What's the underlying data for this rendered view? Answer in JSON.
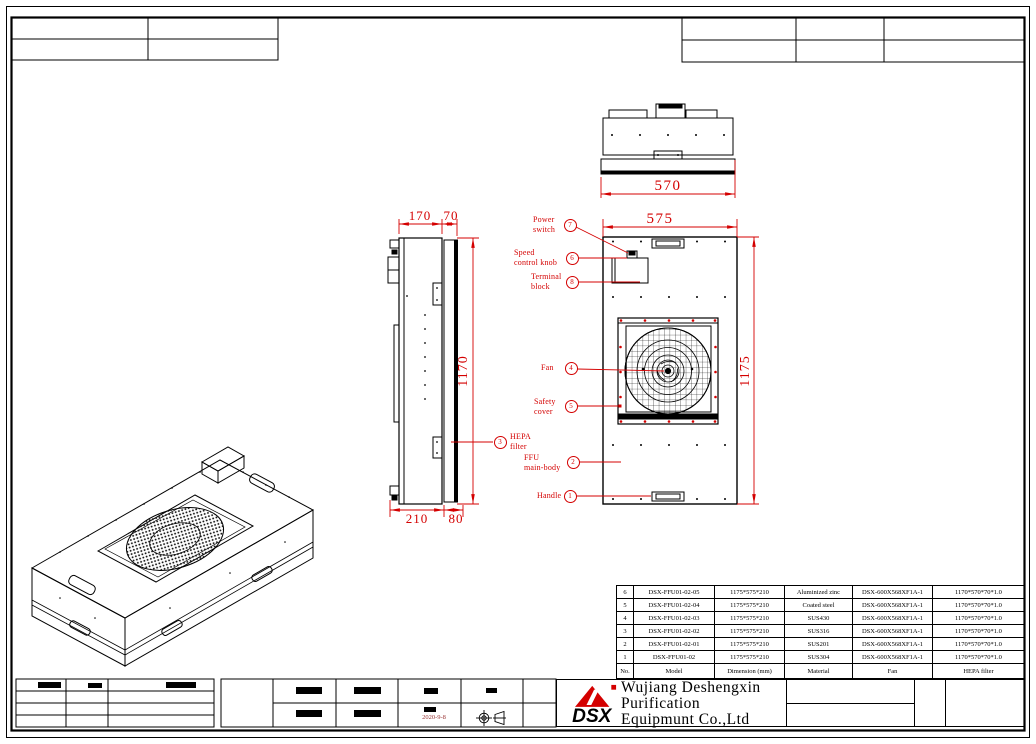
{
  "dimensions": {
    "top_width": "570",
    "front_width": "575",
    "front_height": "1175",
    "side_depth_a": "170",
    "side_depth_b": "70",
    "side_bottom_a": "210",
    "side_bottom_b": "80",
    "filter_height": "1170"
  },
  "callouts": [
    {
      "num": "7",
      "label": "Power\nswitch"
    },
    {
      "num": "6",
      "label": "Speed\ncontrol knob"
    },
    {
      "num": "8",
      "label": "Terminal\nblock"
    },
    {
      "num": "4",
      "label": "Fan"
    },
    {
      "num": "5",
      "label": "Safety\ncover"
    },
    {
      "num": "3",
      "label": "HEPA\nfilter"
    },
    {
      "num": "2",
      "label": "FFU\nmain-body"
    },
    {
      "num": "1",
      "label": "Handle"
    }
  ],
  "parts_table": {
    "headers": [
      "No.",
      "Model",
      "Dimension (mm)",
      "Material",
      "Fan",
      "HEPA filter"
    ],
    "rows": [
      {
        "no": "6",
        "model": "DSX-FFU01-02-05",
        "dimension": "1175*575*210",
        "material": "Aluminized zinc",
        "fan": "DSX-600X568XF1A-1",
        "hepa": "1170*570*70*1.0"
      },
      {
        "no": "5",
        "model": "DSX-FFU01-02-04",
        "dimension": "1175*575*210",
        "material": "Coated steel",
        "fan": "DSX-600X568XF1A-1",
        "hepa": "1170*570*70*1.0"
      },
      {
        "no": "4",
        "model": "DSX-FFU01-02-03",
        "dimension": "1175*575*210",
        "material": "SUS430",
        "fan": "DSX-600X568XF1A-1",
        "hepa": "1170*570*70*1.0"
      },
      {
        "no": "3",
        "model": "DSX-FFU01-02-02",
        "dimension": "1175*575*210",
        "material": "SUS316",
        "fan": "DSX-600X568XF1A-1",
        "hepa": "1170*570*70*1.0"
      },
      {
        "no": "2",
        "model": "DSX-FFU01-02-01",
        "dimension": "1175*575*210",
        "material": "SUS201",
        "fan": "DSX-600X568XF1A-1",
        "hepa": "1170*570*70*1.0"
      },
      {
        "no": "1",
        "model": "DSX-FFU01-02",
        "dimension": "1175*575*210",
        "material": "SUS304",
        "fan": "DSX-600X568XF1A-1",
        "hepa": "1170*570*70*1.0"
      }
    ]
  },
  "title_block": {
    "logo_text": "DSX",
    "company": "Wujiang Deshengxin\nPurification\nEquipmunt Co.,Ltd",
    "date": "2020-9-8"
  },
  "colors": {
    "accent_red": "#d40000",
    "line_black": "#000000"
  }
}
